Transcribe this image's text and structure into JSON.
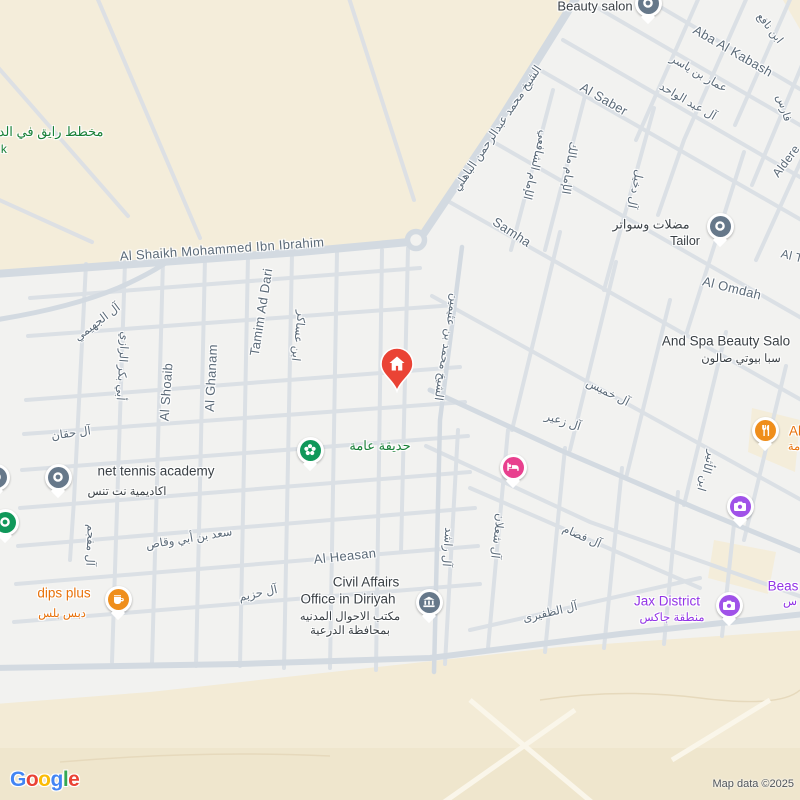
{
  "map": {
    "colors": {
      "land": "#f2f2f0",
      "terrain": "#f4edda",
      "road_minor": "#dbe0e5",
      "road_major": "#d3dae1",
      "street_label": "#5b6a78",
      "poi_black": "#3a4045",
      "poi_green": "#188038",
      "poi_orange": "#e8710a",
      "poi_purple": "#9334e6",
      "pin_grey": "#66788a",
      "pin_green": "#10985a",
      "pin_orange": "#ef8e1b",
      "pin_pink": "#e8408e",
      "pin_purple": "#a052e8",
      "marker_red": "#ea4335"
    },
    "street_labels": [
      {
        "t": "Aba Al Kabash",
        "x": 733,
        "y": 51,
        "r": 30,
        "s": 13
      },
      {
        "t": "عمار بن ياسر",
        "x": 699,
        "y": 73,
        "r": 30,
        "s": 11.5
      },
      {
        "t": "آل عبد الواحد",
        "x": 688,
        "y": 101,
        "r": 30,
        "s": 11.5
      },
      {
        "t": "ابن نافع",
        "x": 770,
        "y": 28,
        "r": 52,
        "s": 11
      },
      {
        "t": "فارس",
        "x": 784,
        "y": 108,
        "r": 72,
        "s": 11
      },
      {
        "t": "Al Saber",
        "x": 604,
        "y": 99,
        "r": 30,
        "s": 13
      },
      {
        "t": "الإمام الشافعي",
        "x": 536,
        "y": 165,
        "r": 104,
        "s": 11.5
      },
      {
        "t": "الإمام مالك",
        "x": 570,
        "y": 168,
        "r": 99,
        "s": 11.5
      },
      {
        "t": "آل دخيل",
        "x": 636,
        "y": 189,
        "r": 102,
        "s": 11.5
      },
      {
        "t": "Aldere",
        "x": 786,
        "y": 161,
        "r": -53,
        "s": 12
      },
      {
        "t": "Samha",
        "x": 512,
        "y": 232,
        "r": 33,
        "s": 13
      },
      {
        "t": "الشيخ محمد عبدالرحمن الباهلي",
        "x": 497,
        "y": 128,
        "r": -56,
        "s": 11.5
      },
      {
        "t": "Al Shaikh Mohammed Ibn Ibrahim",
        "x": 222,
        "y": 249,
        "r": -4,
        "s": 13
      },
      {
        "t": "Tamim Ad Dari",
        "x": 261,
        "y": 312,
        "r": -81,
        "s": 13
      },
      {
        "t": "ابن عساكر",
        "x": 299,
        "y": 336,
        "r": 97,
        "s": 11.5
      },
      {
        "t": "Al Ghanam",
        "x": 211,
        "y": 378,
        "r": -87,
        "s": 13
      },
      {
        "t": "Al Shoaib",
        "x": 166,
        "y": 392,
        "r": -86,
        "s": 13
      },
      {
        "t": "أبي بكر الرازي",
        "x": 123,
        "y": 366,
        "r": 94,
        "s": 11.5
      },
      {
        "t": "آل الجهيمي",
        "x": 97,
        "y": 322,
        "r": -37,
        "s": 11.5
      },
      {
        "t": "آل حقان",
        "x": 71,
        "y": 433,
        "r": -8,
        "s": 11.5
      },
      {
        "t": "آل مفجم",
        "x": 91,
        "y": 545,
        "r": 92,
        "s": 11.5
      },
      {
        "t": "سعد بن أبي وقاص",
        "x": 189,
        "y": 538,
        "r": -9,
        "s": 11.5
      },
      {
        "t": "آل حزيم",
        "x": 258,
        "y": 593,
        "r": -12,
        "s": 11.5
      },
      {
        "t": "Al Heasan",
        "x": 345,
        "y": 556,
        "r": -6,
        "s": 13
      },
      {
        "t": "آل راشد",
        "x": 448,
        "y": 547,
        "r": 94,
        "s": 11.5
      },
      {
        "t": "آل شعلان",
        "x": 498,
        "y": 536,
        "r": 97,
        "s": 11.5
      },
      {
        "t": "آل فصام",
        "x": 582,
        "y": 536,
        "r": 24,
        "s": 11.5
      },
      {
        "t": "آل الظفيرى",
        "x": 550,
        "y": 612,
        "r": -13,
        "s": 11.5
      },
      {
        "t": "آل خميس",
        "x": 608,
        "y": 392,
        "r": 27,
        "s": 11.5
      },
      {
        "t": "آل زعير",
        "x": 563,
        "y": 421,
        "r": 18,
        "s": 11.5
      },
      {
        "t": "ابن الأثير",
        "x": 707,
        "y": 471,
        "r": 106,
        "s": 11.5
      },
      {
        "t": "الشيخ محمد بن عثيمين",
        "x": 447,
        "y": 347,
        "r": 99,
        "s": 11.5
      },
      {
        "t": "Al Omdah",
        "x": 732,
        "y": 288,
        "r": 14,
        "s": 13
      },
      {
        "t": "Al T",
        "x": 792,
        "y": 256,
        "r": 14,
        "s": 12
      }
    ],
    "area_labels": [
      {
        "t": "مخطط رايق في الدرع",
        "x": 44,
        "y": 132,
        "c": "#188038",
        "s": 13
      },
      {
        "t": "k",
        "x": 4,
        "y": 149,
        "c": "#188038",
        "s": 12
      }
    ],
    "pois": [
      {
        "id": "beauty-salon",
        "pin": {
          "x": 648,
          "y": 3,
          "c": "#66788a",
          "icon": "dot-icon"
        },
        "lines": [
          {
            "t": "Beauty salon",
            "x": 595,
            "y": 6,
            "c": "#3a4045",
            "s": 13
          }
        ]
      },
      {
        "id": "tailor",
        "pin": {
          "x": 720,
          "y": 226,
          "c": "#66788a",
          "icon": "dot-icon"
        },
        "lines": [
          {
            "t": "مضلات وسواتر",
            "x": 651,
            "y": 224,
            "c": "#3a4045",
            "s": 12.5
          },
          {
            "t": "Tailor",
            "x": 685,
            "y": 241,
            "c": "#3a4045",
            "s": 12.5
          }
        ]
      },
      {
        "id": "and-spa-beauty-salon",
        "lines": [
          {
            "t": "And Spa Beauty Salo",
            "x": 726,
            "y": 341,
            "c": "#3a4045",
            "s": 13.5
          },
          {
            "t": "سبا بيوتي صالون",
            "x": 741,
            "y": 358,
            "c": "#3a4045",
            "s": 11.5
          }
        ]
      },
      {
        "id": "net-tennis-academy",
        "pin": {
          "x": 58,
          "y": 477,
          "c": "#66788a",
          "icon": "dot-icon"
        },
        "lines": [
          {
            "t": "net tennis academy",
            "x": 156,
            "y": 471,
            "c": "#3a4045",
            "s": 13.5
          },
          {
            "t": "اكاديمية نت تنس",
            "x": 127,
            "y": 491,
            "c": "#3a4045",
            "s": 11.5
          }
        ]
      },
      {
        "id": "poi-edge-grey",
        "pin": {
          "x": -4,
          "y": 477,
          "c": "#66788a",
          "icon": "dot-icon"
        }
      },
      {
        "id": "poi-edge-green",
        "pin": {
          "x": 5,
          "y": 522,
          "c": "#10985a",
          "icon": "dot-icon"
        }
      },
      {
        "id": "public-park",
        "pin": {
          "x": 310,
          "y": 450,
          "c": "#10985a",
          "icon": "flower-icon"
        },
        "lines": [
          {
            "t": "حديقة عامة",
            "x": 380,
            "y": 446,
            "c": "#188038",
            "s": 13
          }
        ]
      },
      {
        "id": "dips-plus",
        "pin": {
          "x": 118,
          "y": 599,
          "c": "#ef8e1b",
          "icon": "coffee-icon"
        },
        "lines": [
          {
            "t": "dips plus",
            "x": 64,
            "y": 593,
            "c": "#e8710a",
            "s": 13.5
          },
          {
            "t": "دبس بلس",
            "x": 62,
            "y": 613,
            "c": "#e8710a",
            "s": 11.5
          }
        ]
      },
      {
        "id": "civil-affairs-office",
        "pin": {
          "x": 429,
          "y": 602,
          "c": "#66788a",
          "icon": "bank-icon"
        },
        "lines": [
          {
            "t": "Civil Affairs",
            "x": 366,
            "y": 582,
            "c": "#3a4045",
            "s": 13.5
          },
          {
            "t": "Office in Diriyah",
            "x": 348,
            "y": 599,
            "c": "#3a4045",
            "s": 13.5
          },
          {
            "t": "مكتب الاحوال المدنيه",
            "x": 350,
            "y": 616,
            "c": "#3a4045",
            "s": 11.5
          },
          {
            "t": "بمحافظة الدرعية",
            "x": 350,
            "y": 630,
            "c": "#3a4045",
            "s": 11.5
          }
        ]
      },
      {
        "id": "jax-district",
        "pin": {
          "x": 729,
          "y": 605,
          "c": "#a052e8",
          "icon": "camera-icon"
        },
        "lines": [
          {
            "t": "Jax District",
            "x": 667,
            "y": 601,
            "c": "#9334e6",
            "s": 13.5
          },
          {
            "t": "منطقة جاكس",
            "x": 672,
            "y": 617,
            "c": "#9334e6",
            "s": 11.5
          }
        ]
      },
      {
        "id": "beast",
        "lines": [
          {
            "t": "Beas",
            "x": 783,
            "y": 586,
            "c": "#9334e6",
            "s": 13.5
          },
          {
            "t": "س",
            "x": 790,
            "y": 601,
            "c": "#9334e6",
            "s": 11.5
          }
        ]
      },
      {
        "id": "restaurant",
        "pin": {
          "x": 765,
          "y": 430,
          "c": "#ef8e1b",
          "icon": "restaurant-icon"
        },
        "lines": [
          {
            "t": "Al",
            "x": 795,
            "y": 431,
            "c": "#e8710a",
            "s": 13.5
          },
          {
            "t": "مة",
            "x": 794,
            "y": 446,
            "c": "#e8710a",
            "s": 11.5
          }
        ]
      },
      {
        "id": "hotel",
        "pin": {
          "x": 513,
          "y": 467,
          "c": "#e8408e",
          "icon": "bed-icon"
        }
      },
      {
        "id": "photo-spot",
        "pin": {
          "x": 740,
          "y": 506,
          "c": "#a052e8",
          "icon": "camera-icon"
        }
      }
    ],
    "marker": {
      "x": 397,
      "y": 366,
      "color": "#ea4335",
      "icon": "home-icon"
    }
  },
  "attribution": {
    "brand": "Google",
    "brand_colors": [
      "#4285F4",
      "#EA4335",
      "#FBBC05",
      "#4285F4",
      "#34A853",
      "#EA4335"
    ],
    "map_data": "Map data ©2025"
  }
}
